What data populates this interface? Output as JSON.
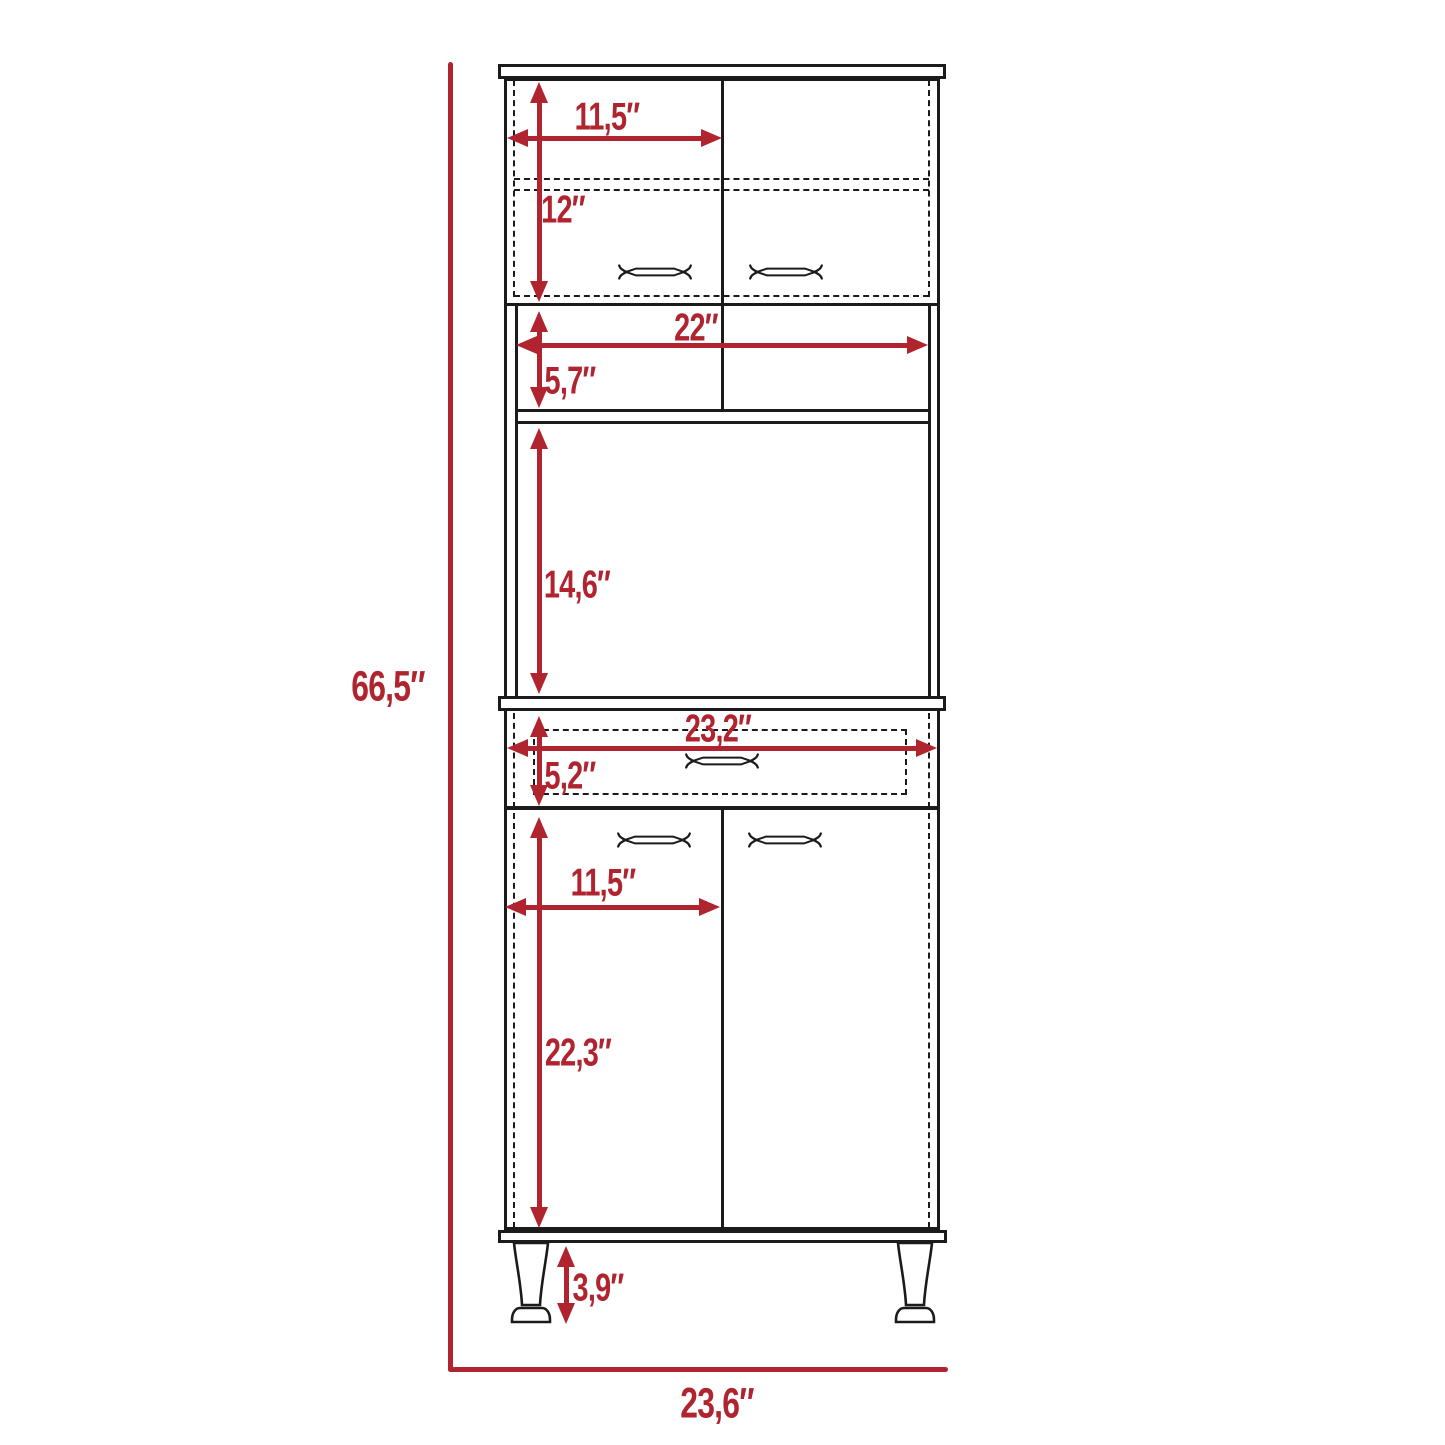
{
  "diagram": {
    "kind": "furniture-dimension-drawing",
    "dims": {
      "top_door_width": "11,5″",
      "top_door_height": "12″",
      "open_shelf_width": "22″",
      "open_shelf_height": "5,7″",
      "microwave_space_height": "14,6″",
      "drawer_width": "23,2″",
      "drawer_height": "5,2″",
      "bottom_door_width": "11,5″",
      "bottom_door_height": "22,3″",
      "leg_height": "3,9″",
      "overall_height": "66,5″",
      "overall_width": "23,6″"
    },
    "colors": {
      "dimension_red": "#b0242f",
      "line_black": "#1b1b1b",
      "background": "#ffffff"
    },
    "glyphs": {
      "door_handle": "bar-handle-icon",
      "drawer_handle": "bar-handle-icon",
      "leg": "tapered-leg-icon"
    }
  }
}
